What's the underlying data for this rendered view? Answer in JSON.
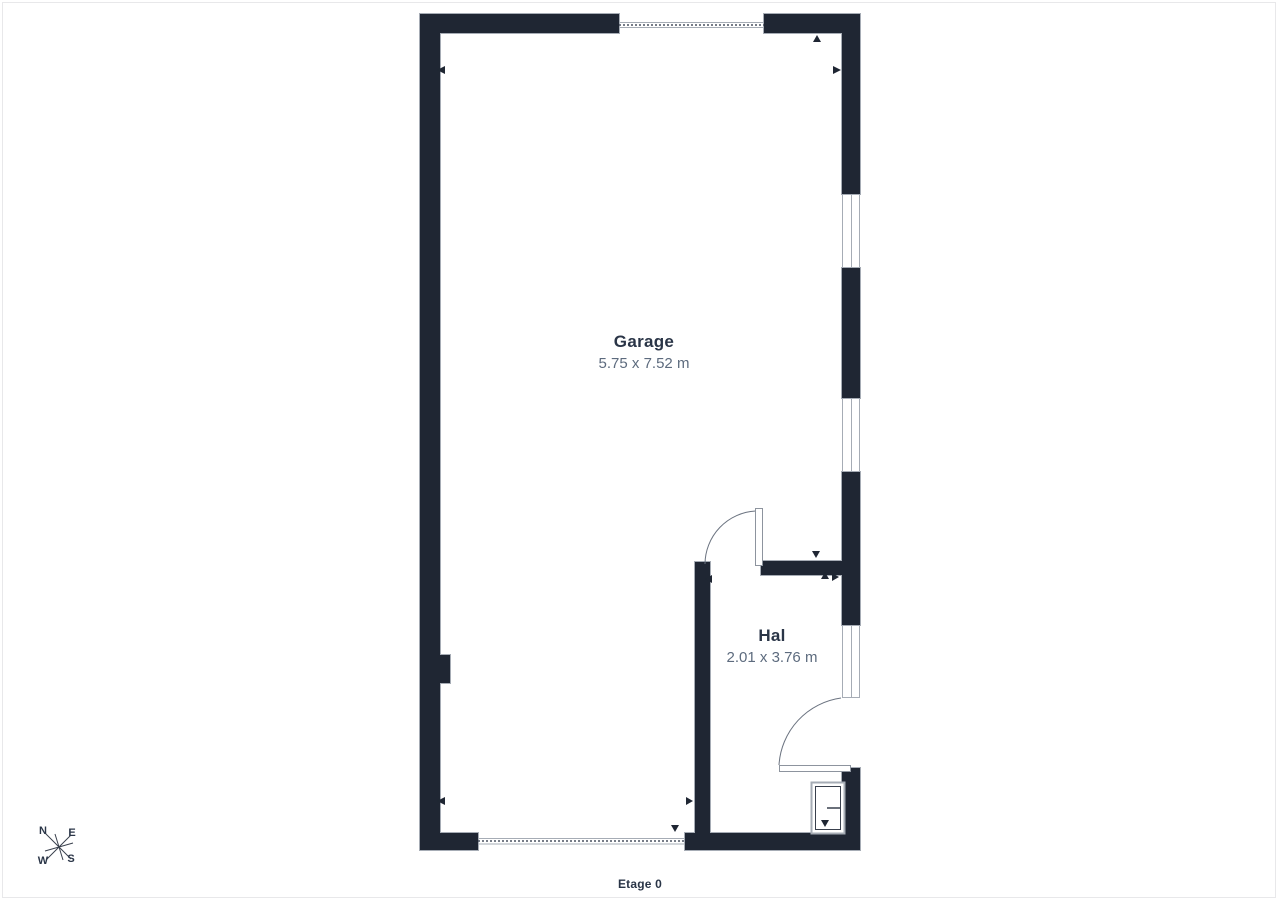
{
  "floorplan": {
    "floor_label": "Etage 0",
    "rooms": [
      {
        "name": "Garage",
        "dimensions": "5.75 x 7.52 m"
      },
      {
        "name": "Hal",
        "dimensions": "2.01 x 3.76 m"
      }
    ],
    "compass": {
      "north": "N",
      "east": "E",
      "west": "W",
      "south": "S"
    },
    "features": [
      "two windows in east wall",
      "sidelight window beside entrance door in east wall",
      "garage door opening (dashed) in north wall",
      "garage door opening (dashed) in south wall",
      "interior door between Garage and Hal with swing arc",
      "entrance door into Hal with swing arc",
      "small meter cabinet in south-east corner of Hal",
      "wall pilaster on west wall"
    ],
    "colors": {
      "wall": "#1f2633",
      "wall_outline": "#a6acb5",
      "room_name_text": "#2a3547",
      "room_dims_text": "#5d6b7e",
      "door_arc": "#6b7380",
      "frame_border": "#e8e8ea",
      "background": "#ffffff"
    }
  }
}
